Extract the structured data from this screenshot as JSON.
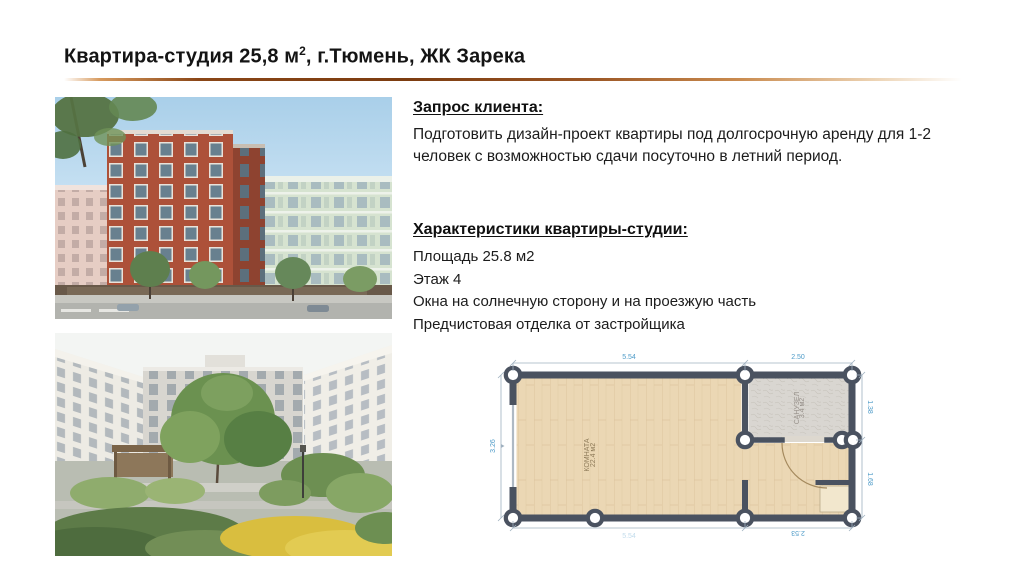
{
  "slide": {
    "title": {
      "main": "Квартира-студия 25,8 м",
      "sup": "2",
      "rest": ", г.Тюмень, ЖК Зарека"
    }
  },
  "client_request": {
    "heading": "Запрос клиента:",
    "body": "Подготовить дизайн-проект квартиры под долгосрочную аренду для 1-2 человек с возможностью сдачи посуточно в летний период."
  },
  "characteristics": {
    "heading": "Характеристики квартиры-студии:",
    "items": [
      "Площадь 25.8 м2",
      "Этаж 4",
      "Окна на солнечную сторону и на проезжую часть",
      "Предчистовая отделка от застройщика"
    ]
  },
  "floorplan": {
    "dims": {
      "top_left": "5.54",
      "top_right": "2.50",
      "right_top": "1.38",
      "right_bottom": "1.68",
      "left": "3.26",
      "bottom_left": "5.54",
      "bottom_right": "2.53"
    },
    "rooms": {
      "main": {
        "label": "КОМНАТА",
        "area": "22.4 м2"
      },
      "bath": {
        "label": "САНУЗЕЛ",
        "area": "3.4 м2"
      }
    },
    "colors": {
      "wall": "#4a5260",
      "wood_floor": "#ebd7b4",
      "bath_floor": "#d9d6d1",
      "dimension_text": "#4e9bc8"
    }
  },
  "accent": {
    "underline_mid": "#7c3c10",
    "underline_light": "#ecd2b2"
  }
}
